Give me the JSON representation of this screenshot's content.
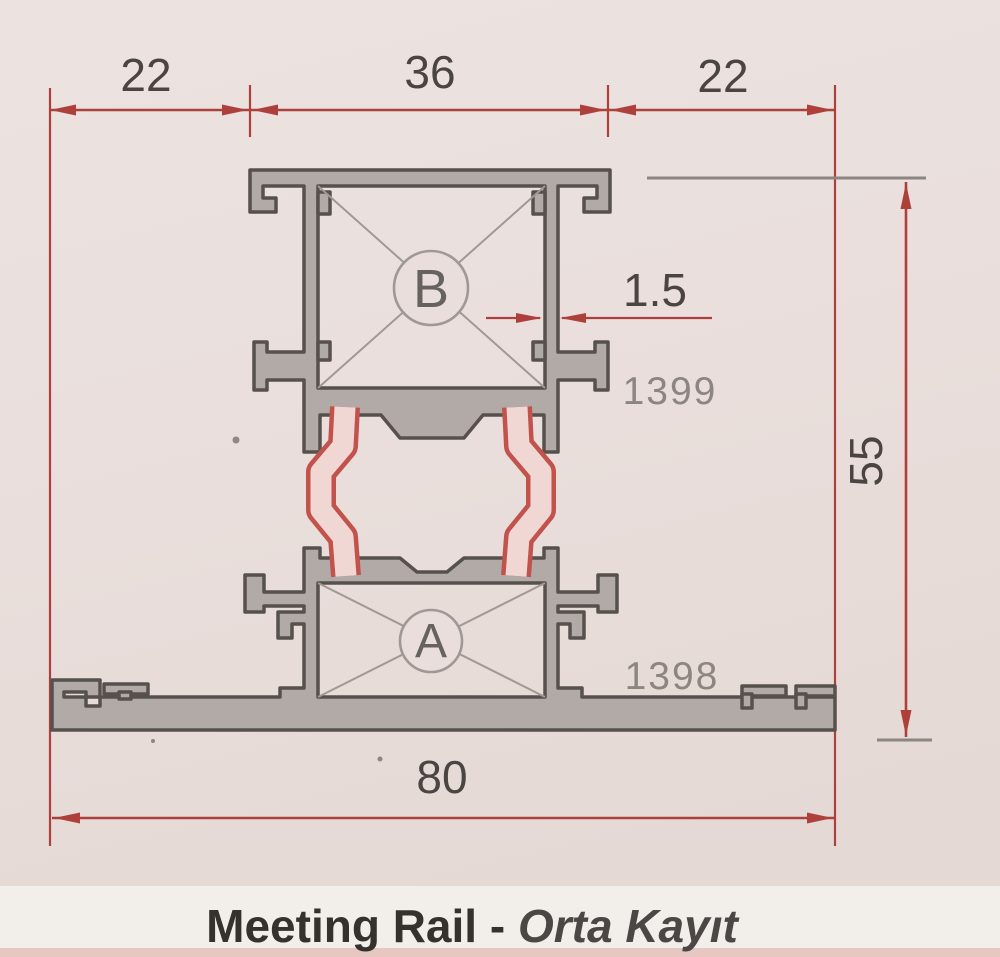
{
  "drawing": {
    "type": "aluminium-profile-cross-section",
    "caption": {
      "main": "Meeting Rail - ",
      "sub": "Orta Kayıt"
    }
  },
  "dimensions": {
    "top_left": "22",
    "top_middle": "36",
    "top_right": "22",
    "overall_width": "80",
    "overall_height": "55",
    "wall_thickness": "1.5"
  },
  "part_numbers": {
    "upper_profile": "1399",
    "lower_profile": "1398"
  },
  "chambers": {
    "upper": "B",
    "lower": "A"
  },
  "colors": {
    "dim_red": "#ae403b",
    "dim_text": "#4a4442",
    "part_gray": "#8d8581",
    "profile_fill": "#b1aaa7",
    "profile_outline": "#57514d",
    "inner_gray": "#a09893",
    "letter_gray": "#676260",
    "strip_pink": "#f1d7d3",
    "strip_red": "#c2524c",
    "paper_top": "#ece3e1",
    "paper_mid": "#e9dedb",
    "paper_bottom": "#e5d9d5",
    "caption_band": "#f2eeea",
    "caption_dark": "#35322e",
    "caption_sub_color": "#4c4744",
    "bottom_strip_pink": "#e6c7c2"
  }
}
